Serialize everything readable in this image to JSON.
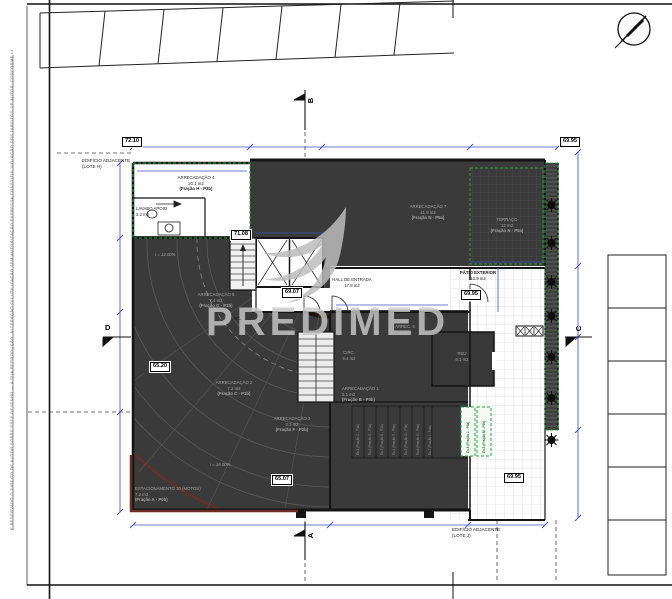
{
  "watermark": {
    "brand": "PREDIMED"
  },
  "site": {
    "adjacent_left_l1": "EDIFÍCIO ADJACENTE",
    "adjacent_left_l2": "(LOTE H)",
    "adjacent_bottom_l1": "EDIFÍCIO ADJACENTE",
    "adjacent_bottom_l2": "(LOTE J)",
    "margin_note": "É RESERVADO O DIREITO DE AUTOR SOBRE ESTE DESENHO — A SUA REPRODUÇÃO, ALTERAÇÃO OU UTILIZAÇÃO SEM AUTORIZAÇÃO EXPRESSA CONSTITUI VIOLAÇÃO DOS DIREITOS DE AUTOR, CONFORME LEGISLAÇÃO EM VIGOR"
  },
  "section_markers": {
    "top": "B",
    "bottom": "A",
    "left": "D",
    "right": "C"
  },
  "elevations": [
    "72.10",
    "69.95",
    "71.08",
    "69.07",
    "69.95",
    "65.20",
    "65.07",
    "69.95"
  ],
  "slopes": {
    "upper": "i = 12.00%",
    "lower": "i = 16.00%"
  },
  "rooms": {
    "arrec4": {
      "l1": "ARRECADAÇÃO 4",
      "l2": "20.1 m2",
      "l3": "(Fração H - P3b)"
    },
    "lavabo": {
      "l1": "LAVABO APOIO",
      "l2": "3.2 m2"
    },
    "arrec7": {
      "l1": "ARRECADAÇÃO 7",
      "l2": "41.9 m2",
      "l3": "(Fração N - P5a)"
    },
    "terraco": {
      "l1": "TERRAÇO",
      "l2": "12 m2",
      "l3": "(Fração N - P5a)"
    },
    "patio": {
      "l1": "PÁTIO EXTERIOR",
      "l2": "13.9 m2"
    },
    "hall": {
      "l1": "HALL DE ENTRADA",
      "l2": "17.8 m2"
    },
    "arrec5": {
      "l1": "ARRECADAÇÃO 5",
      "l2": "7.4 m2",
      "l3": "(Fração G - P1b)"
    },
    "wc": {
      "l1": "WC."
    },
    "arrec6": {
      "l1": "ARREC. 6",
      "l2": "5.2 m2"
    },
    "circ": {
      "l1": "CIRC.",
      "l2": "9.4 m2"
    },
    "rsu": {
      "l1": "RSU",
      "l2": "9.1 m2"
    },
    "arrec2": {
      "l1": "ARRECADAÇÃO 2",
      "l2": "7.2 m2",
      "l3": "(Fração C - P1b)"
    },
    "arrec3": {
      "l1": "ARRECADAÇÃO 3",
      "l2": "3.3 m2",
      "l3": "(Fração F - P2b)"
    },
    "arrec1": {
      "l1": "ARRECADAÇÃO 1",
      "l2": "5.1 m2",
      "l3": "(Fração B - P0b)"
    },
    "est10": {
      "l1": "ESTACIONAMENTO 10 (MOTOS)",
      "l2": "7.2 m2",
      "l3": "(Fração A - P0b)"
    }
  },
  "stalls": [
    "Es.1 (Fração C - P1b)",
    "Es.2 (Fração D - P2a)",
    "Es.3 (Fração E - P2b)",
    "Es.4 (Fração F - P3a)",
    "Es.5 (Fração G - P3b)",
    "Es.6 (Fração H - P4a)",
    "Es.7 (Fração I - P4b)",
    "Es.8 (Fração L - P5a)",
    "Es.9 (Fração M - P5b)"
  ],
  "colors": {
    "dark_fill": "#3a3a3a",
    "green_accent": "#2aa23d",
    "blue_dim": "#3a50c2",
    "brown_accent": "#6a2f22",
    "watermark_gray": "#bdbdbd"
  }
}
